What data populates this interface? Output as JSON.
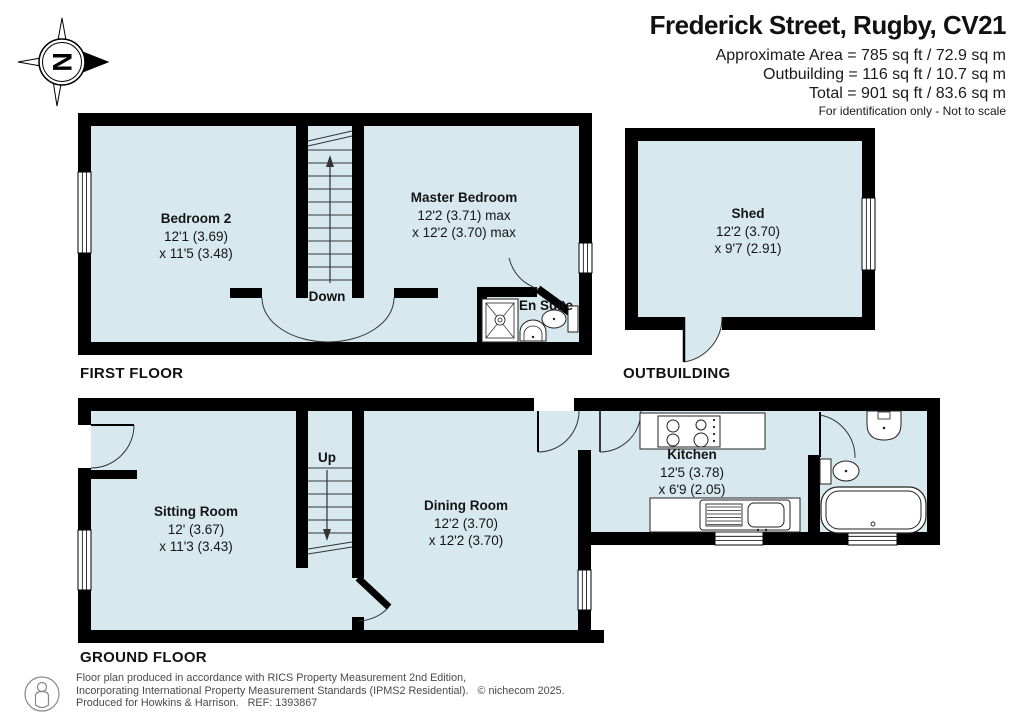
{
  "header": {
    "title": "Frederick Street, Rugby, CV21",
    "area_line1": "Approximate Area = 785 sq ft / 72.9 sq m",
    "area_line2": "Outbuilding = 116 sq ft / 10.7 sq m",
    "area_line3": "Total = 901 sq ft / 83.6 sq m",
    "note": "For identification only - Not to scale"
  },
  "compass": {
    "north_label": "N"
  },
  "floors": {
    "first_floor": {
      "label": "FIRST FLOOR"
    },
    "outbuilding": {
      "label": "OUTBUILDING"
    },
    "ground_floor": {
      "label": "GROUND FLOOR"
    }
  },
  "rooms": {
    "bedroom2": {
      "name": "Bedroom 2",
      "dim1": "12'1 (3.69)",
      "dim2": "x 11'5 (3.48)"
    },
    "master_bedroom": {
      "name": "Master Bedroom",
      "dim1": "12'2 (3.71) max",
      "dim2": "x 12'2 (3.70) max"
    },
    "en_suite": {
      "name": "En Suite"
    },
    "shed": {
      "name": "Shed",
      "dim1": "12'2 (3.70)",
      "dim2": "x 9'7 (2.91)"
    },
    "sitting_room": {
      "name": "Sitting Room",
      "dim1": "12' (3.67)",
      "dim2": "x 11'3 (3.43)"
    },
    "dining_room": {
      "name": "Dining Room",
      "dim1": "12'2 (3.70)",
      "dim2": "x 12'2 (3.70)"
    },
    "kitchen": {
      "name": "Kitchen",
      "dim1": "12'5 (3.78)",
      "dim2": "x 6'9 (2.05)"
    }
  },
  "stairs": {
    "first_floor_label": "Down",
    "ground_floor_label": "Up"
  },
  "footer": {
    "line1": "Floor plan produced in accordance with RICS Property Measurement 2nd Edition,",
    "line2": "Incorporating International Property Measurement Standards (IPMS2 Residential).   © nichecom 2025.",
    "line3": "Produced for Howkins & Harrison.   REF: 1393867"
  },
  "colors": {
    "room_fill": "#d8e8ef",
    "wall": "#000000",
    "fixture_stroke": "#222222"
  }
}
